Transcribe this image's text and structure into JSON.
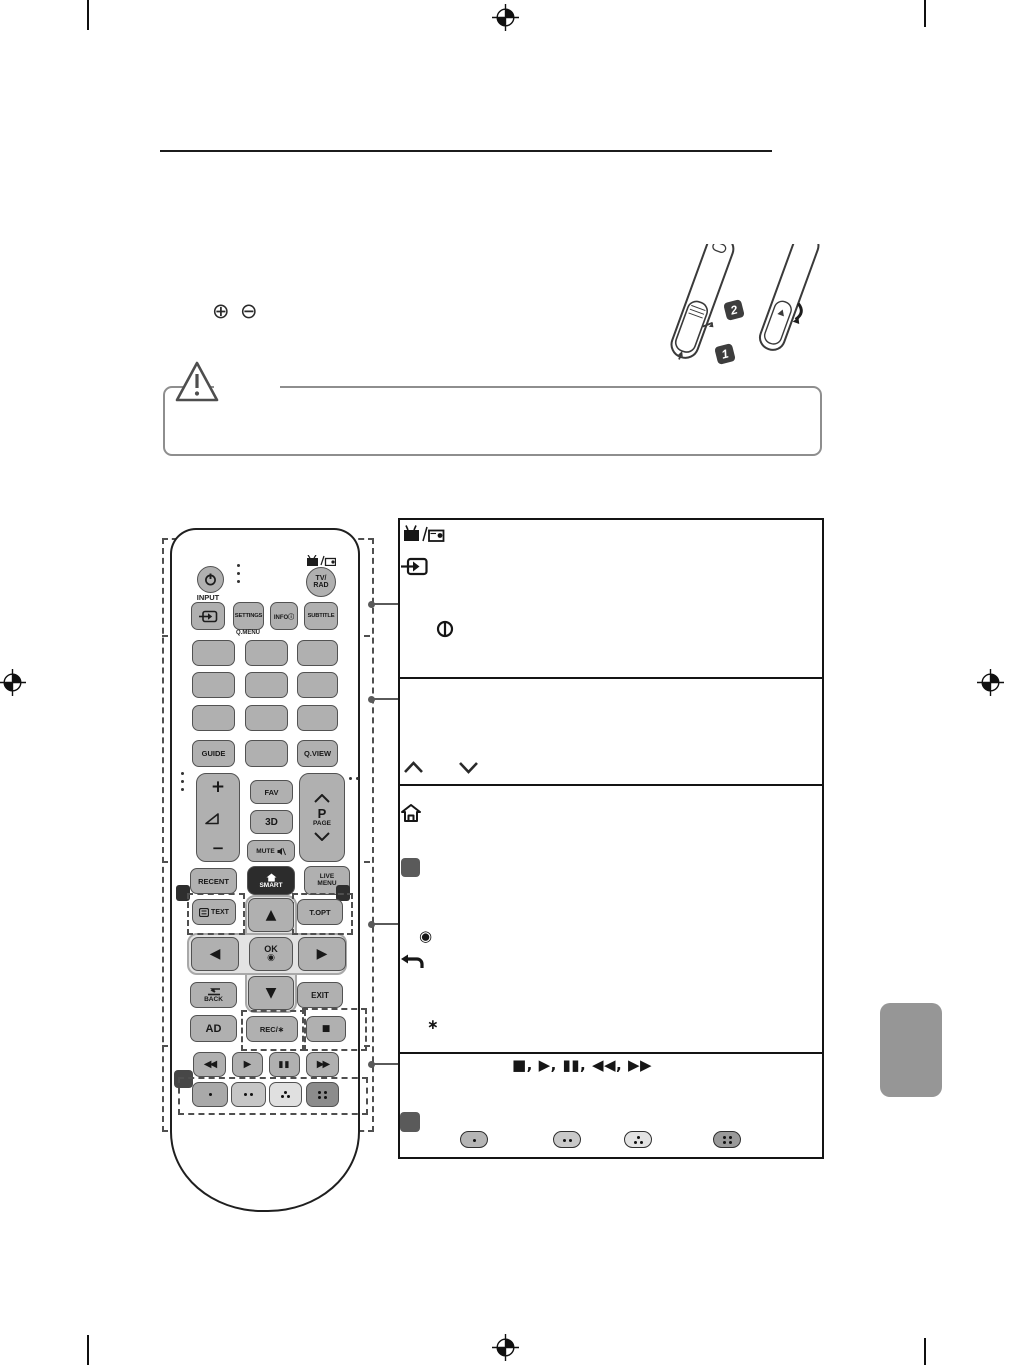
{
  "page": {
    "background": "#ffffff",
    "kind": "tv-manual-remote-page"
  },
  "polarity": {
    "plus": "⊕",
    "minus": "⊖"
  },
  "battery_figure": {
    "step1": "1",
    "step2": "2"
  },
  "remote": {
    "section1": {
      "input_label": "INPUT",
      "settings": "SETTINGS",
      "qmenu": "Q.MENU",
      "info": "INFOⓘ",
      "subtitle": "SUBTITLE",
      "tvrad_line1": "TV/",
      "tvrad_line2": "RAD"
    },
    "section2": {
      "guide": "GUIDE",
      "qview": "Q.VIEW",
      "vol_plus": "+",
      "vol_minus": "−",
      "fav": "FAV",
      "threeD": "3D",
      "mute": "MUTE",
      "p": "P",
      "page": "PAGE"
    },
    "section3": {
      "recent": "RECENT",
      "smart": "SMART",
      "live_line1": "LIVE",
      "live_line2": "MENU",
      "text": "TEXT",
      "topt": "T.OPT",
      "up": "▲",
      "down": "▼",
      "left": "◀",
      "right": "▶",
      "ok": "OK",
      "ok_symbol": "◉",
      "back": "BACK",
      "exit": "EXIT",
      "ad": "AD",
      "rec": "REC/∗",
      "stop": "■"
    },
    "section4": {
      "rewind": "◀◀",
      "play": "▶",
      "pause": "▮▮",
      "forward": "▶▶",
      "color_buttons": [
        "red-one-dot",
        "green-two-dots",
        "yellow-three-dots",
        "blue-four-dots"
      ]
    }
  },
  "description_table": {
    "row1_icons": [
      "tv-radio-icon",
      "input-icon",
      "power-circle-icon"
    ],
    "row2_icons": [
      "chevron-up-icon",
      "chevron-down-icon"
    ],
    "row3_icons": [
      "home-icon",
      "gray-button-swatch",
      "ok-symbol",
      "back-arrow-icon",
      "asterisk"
    ],
    "row3_ok_symbol": "◉",
    "row3_asterisk": "∗",
    "row4_media_sequence": "■, ▶, ▮▮, ◀◀, ▶▶",
    "row4_icons": [
      "gray-button-swatch",
      "one-dot-pill",
      "two-dot-pill",
      "three-dot-pill",
      "four-dot-pill"
    ]
  },
  "colors": {
    "button_gray": "#b0b0b0",
    "button_border": "#525252",
    "smart_button_dark": "#2c2c2c",
    "table_border": "#141414",
    "page_tab_gray": "#969696",
    "color_button_shades": [
      "#a9a9a9",
      "#c6c6c6",
      "#e0e0e0",
      "#8c8c8c"
    ]
  }
}
